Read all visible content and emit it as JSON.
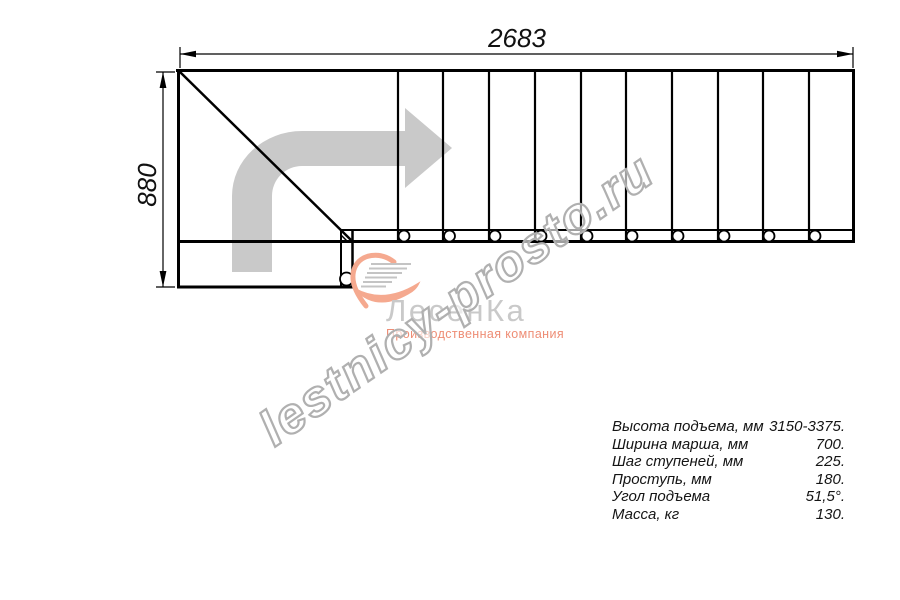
{
  "drawing": {
    "width_label": "2683",
    "height_label": "880"
  },
  "watermark": {
    "text": "lestnicy-prosto.ru"
  },
  "logo": {
    "brand": "ЛесенКа",
    "tagline": "Производственная компания"
  },
  "specs": {
    "rows": [
      {
        "label": "Высота подъема, мм",
        "value": "3150-3375."
      },
      {
        "label": "Ширина марша, мм",
        "value": "700."
      },
      {
        "label": "Шаг ступеней, мм",
        "value": "225."
      },
      {
        "label": "Проступь, мм",
        "value": "180."
      },
      {
        "label": "Угол подъема",
        "value": "51,5°."
      },
      {
        "label": "Масса, кг",
        "value": "130."
      }
    ]
  },
  "colors": {
    "line": "#000000",
    "arrow_gray": "#c9c9c9",
    "watermark_gray": "#b0b0b0",
    "logo_text_gray": "#c9c9c9",
    "logo_salmon": "#f5a98f",
    "tagline_salmon": "#ee8d75"
  }
}
